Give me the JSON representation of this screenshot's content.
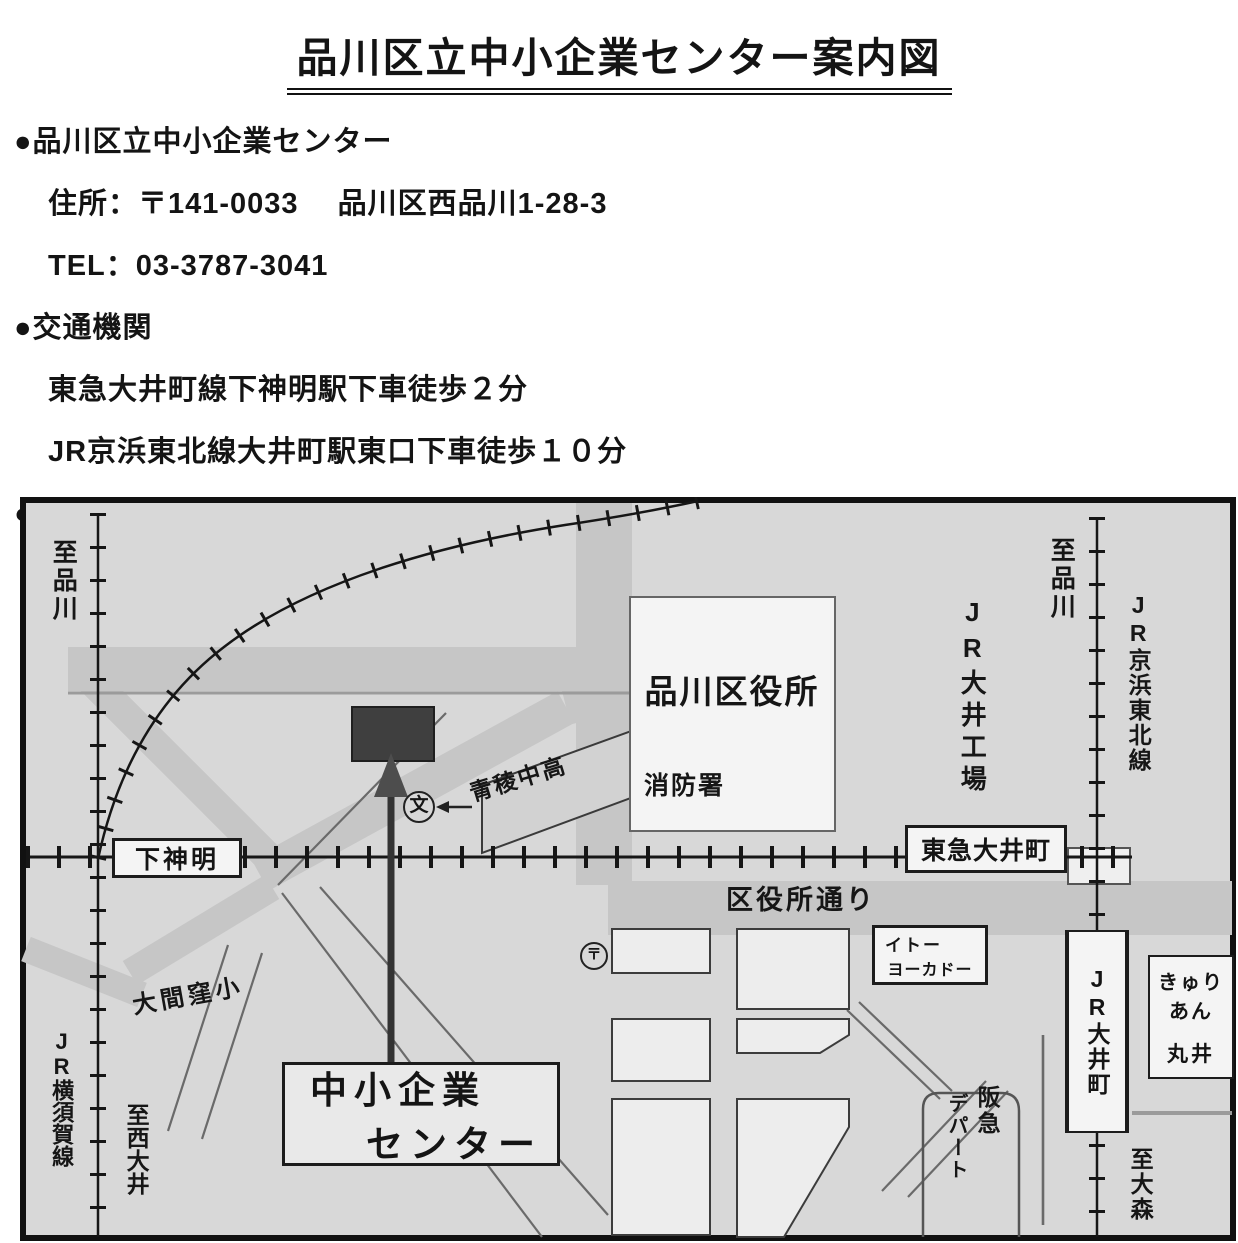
{
  "document": {
    "title": "品川区立中小企業センター案内図",
    "lines": [
      {
        "text": "●品川区立中小企業センター"
      },
      {
        "text": "住所：〒141-0033　 品川区西品川1-28-3"
      },
      {
        "text": "TEL：03-3787-3041"
      },
      {
        "text": "●交通機関"
      },
      {
        "text": "東急大井町線下神明駅下車徒歩２分"
      },
      {
        "text": "JR京浜東北線大井町駅東口下車徒歩１０分"
      },
      {
        "text": "●JR大井町駅及び東急下神明駅周辺図"
      }
    ]
  },
  "map": {
    "labels": {
      "to_shinagawa_left": "至品川",
      "to_shinagawa_right": "至品川",
      "jr_yokosuka_line": "JR横須賀線",
      "to_nishi_oi": "至西大井",
      "shimo_shinmei_station": "下神明",
      "omakubo_school": "大間窪小",
      "sme_center_line1": "中小企業",
      "sme_center_line2": "センター",
      "seiryo_school": "青稜中高",
      "school_symbol": "文",
      "post_symbol": "〒",
      "shinagawa_ward_office": "品川区役所",
      "fire_station": "消防署",
      "kuyakusho_dori": "区役所通り",
      "tokyu_oimachi_station": "東急大井町",
      "jr_oi_factory": "JR大井工場",
      "jr_keihin_tohoku_line": "JR京浜東北線",
      "ito_yokado_line1": "イトー",
      "ito_yokado_line2": "ヨーカドー",
      "jr_oimachi_station": "JR大井町",
      "curian_line1": "きゅり",
      "curian_line2": "あん",
      "marui": "丸井",
      "hankyu": "阪急",
      "depato": "デパート",
      "to_omori": "至大森"
    },
    "colors": {
      "map_background": "#d8d8d8",
      "road_gray": "#c6c6c6",
      "rail_black": "#161616",
      "building_white": "#f4f4f4",
      "building_dark": "#3f3f3f"
    }
  }
}
